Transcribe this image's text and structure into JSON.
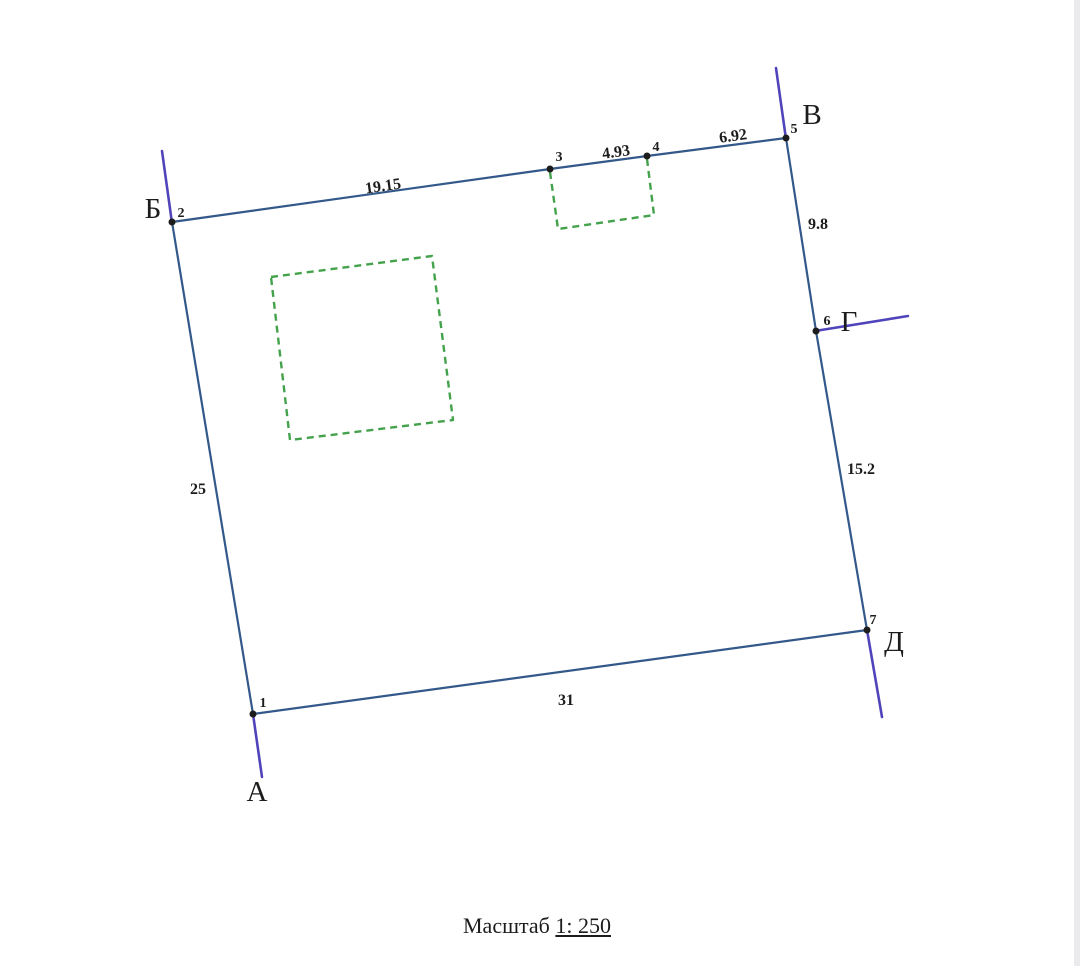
{
  "plan": {
    "letters": {
      "A": "А",
      "B": "Б",
      "V": "В",
      "G": "Г",
      "D": "Д"
    },
    "points": {
      "p1": "1",
      "p2": "2",
      "p3": "3",
      "p4": "4",
      "p5": "5",
      "p6": "6",
      "p7": "7"
    },
    "dimensions": {
      "d23": "19.15",
      "d34": "4.93",
      "d45": "6.92",
      "d56": "9.8",
      "d67": "15.2",
      "d12": "25",
      "d17": "31"
    },
    "scale": {
      "label": "Масштаб",
      "value": "1: 250"
    },
    "colors": {
      "boundary": "#33588a",
      "bearing": "#5044bb",
      "outbuilding": "#43a24b",
      "ink": "#1c1c1c",
      "page": "#ffffff",
      "edge": "#ebebed"
    }
  }
}
